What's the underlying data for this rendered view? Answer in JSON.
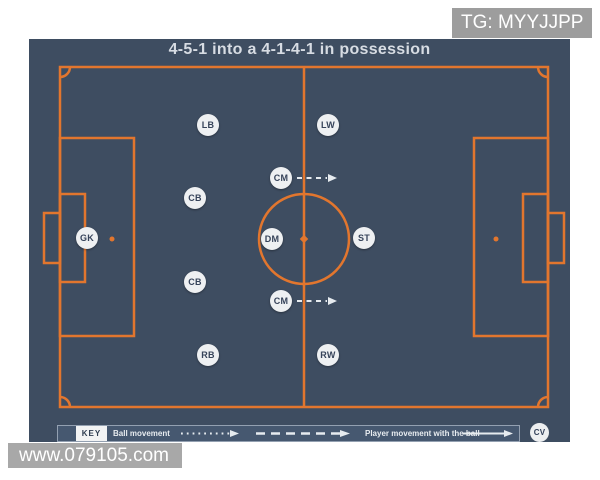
{
  "watermarks": {
    "top_right": "TG: MYYJJPP",
    "bottom_left": "www.079105.com"
  },
  "board": {
    "title": "4-5-1 into a 4-1-4-1 in possession",
    "colors": {
      "background": "#3e4d61",
      "pitch_line": "#e2762e",
      "badge_background": "#eef0f2",
      "badge_text": "#36435a",
      "title_text": "#d7dce3",
      "arrow_white": "#e6ebef",
      "watermark_gray": "#a5a5a5"
    }
  },
  "players": [
    {
      "label": "GK",
      "x": 58,
      "y": 199,
      "movement_arrow": false
    },
    {
      "label": "LB",
      "x": 179,
      "y": 86,
      "movement_arrow": false
    },
    {
      "label": "CB",
      "x": 166,
      "y": 159,
      "movement_arrow": false
    },
    {
      "label": "CB",
      "x": 166,
      "y": 243,
      "movement_arrow": false
    },
    {
      "label": "RB",
      "x": 179,
      "y": 316,
      "movement_arrow": false
    },
    {
      "label": "CM",
      "x": 252,
      "y": 139,
      "movement_arrow": true
    },
    {
      "label": "DM",
      "x": 243,
      "y": 200,
      "movement_arrow": false
    },
    {
      "label": "CM",
      "x": 252,
      "y": 262,
      "movement_arrow": true
    },
    {
      "label": "LW",
      "x": 299,
      "y": 86,
      "movement_arrow": false
    },
    {
      "label": "ST",
      "x": 335,
      "y": 199,
      "movement_arrow": false
    },
    {
      "label": "RW",
      "x": 299,
      "y": 316,
      "movement_arrow": false
    }
  ],
  "key": {
    "label": "KEY",
    "items": [
      {
        "label": "Ball movement",
        "line_style": "dotted"
      },
      {
        "label": "",
        "line_style": "dashed"
      },
      {
        "label": "Player movement with the ball",
        "line_style": "solid"
      }
    ]
  },
  "logo": {
    "text": "CV"
  }
}
